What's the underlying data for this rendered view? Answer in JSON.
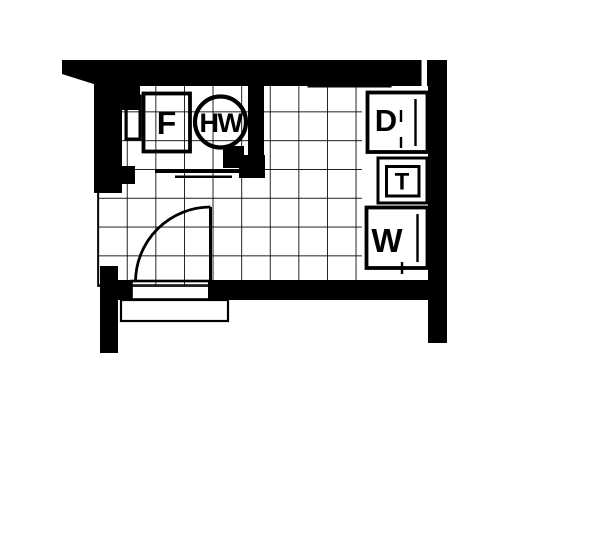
{
  "floor_plan": {
    "appliance_labels": {
      "freezer": "F",
      "water_heater": "HW",
      "dryer": "D",
      "tub": "T",
      "washer": "W"
    },
    "colors": {
      "ink": "#000000",
      "paper": "#ffffff"
    }
  }
}
